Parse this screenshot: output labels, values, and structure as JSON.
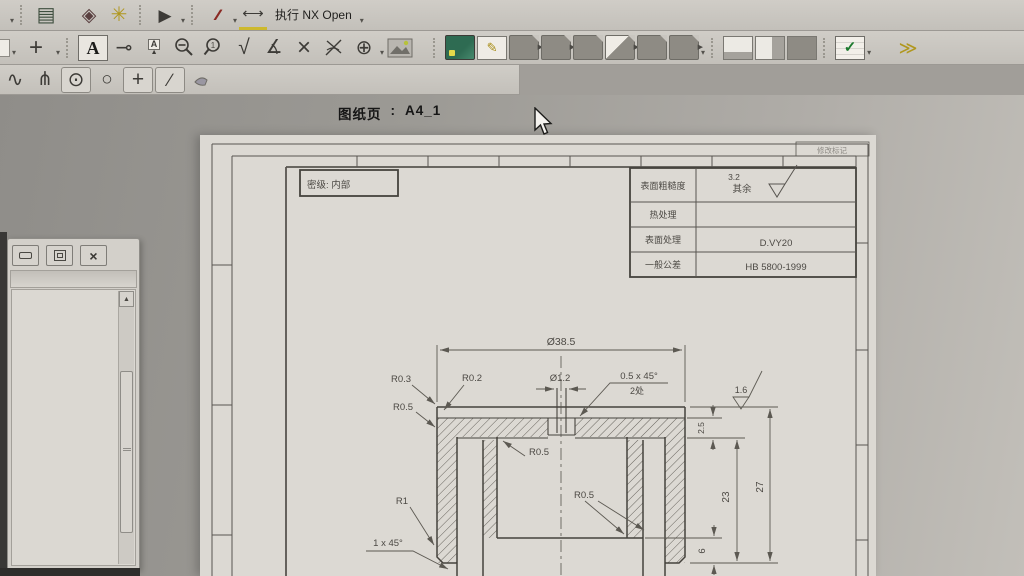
{
  "toolbar": {
    "nx_open_label": "执行 NX Open",
    "glyphs": {
      "stack": "▤",
      "diamond": "◈",
      "gear": "✳",
      "play": "▶",
      "strikes": "∕∕∕",
      "ruler": "⟷",
      "caret": "▾",
      "crosshair": "+",
      "text_a": "A",
      "leader": "⊸",
      "flag_a": "A",
      "flag_pole": "▲",
      "sqrt": "√",
      "angle": "∡",
      "cross": "×",
      "target": "⊕",
      "pencil": "✎",
      "check": "✓",
      "squiggle": "∿",
      "pitchfork": "⋔",
      "circle_dot": "⊙",
      "circle": "○",
      "plus": "+",
      "slash": "∕",
      "chevrons": "≫"
    }
  },
  "status": {
    "sheet_label": "图纸页",
    "separator": ":",
    "sheet_name": "A4_1"
  },
  "panel": {
    "close_glyph": "×",
    "scroll_up_glyph": "▲"
  },
  "drawing": {
    "security_label": "密级: 内部",
    "revision_label": "修改标记",
    "title_block": {
      "rows": [
        {
          "label": "表面粗糙度",
          "value": "其余"
        },
        {
          "label": "热处理",
          "value": ""
        },
        {
          "label": "表面处理",
          "value": "D.VY20"
        },
        {
          "label": "一般公差",
          "value": "HB 5800-1999"
        }
      ],
      "roughness_value": "3.2"
    },
    "dims": {
      "overall_dia": "Ø38.5",
      "hole_dia": "Ø1.2",
      "chamfer_top": "0.5 x 45°",
      "chamfer_places": "2处",
      "r03": "R0.3",
      "r02": "R0.2",
      "r05_left": "R0.5",
      "r05_cavity": "R0.5",
      "r05_floor": "R0.5",
      "r1": "R1",
      "chamfer_bottom": "1 x 45°",
      "roughness_side": "1.6",
      "web_thickness": "2.5",
      "height_overall": "27",
      "height_inner": "23",
      "floor_thickness": "6"
    }
  }
}
